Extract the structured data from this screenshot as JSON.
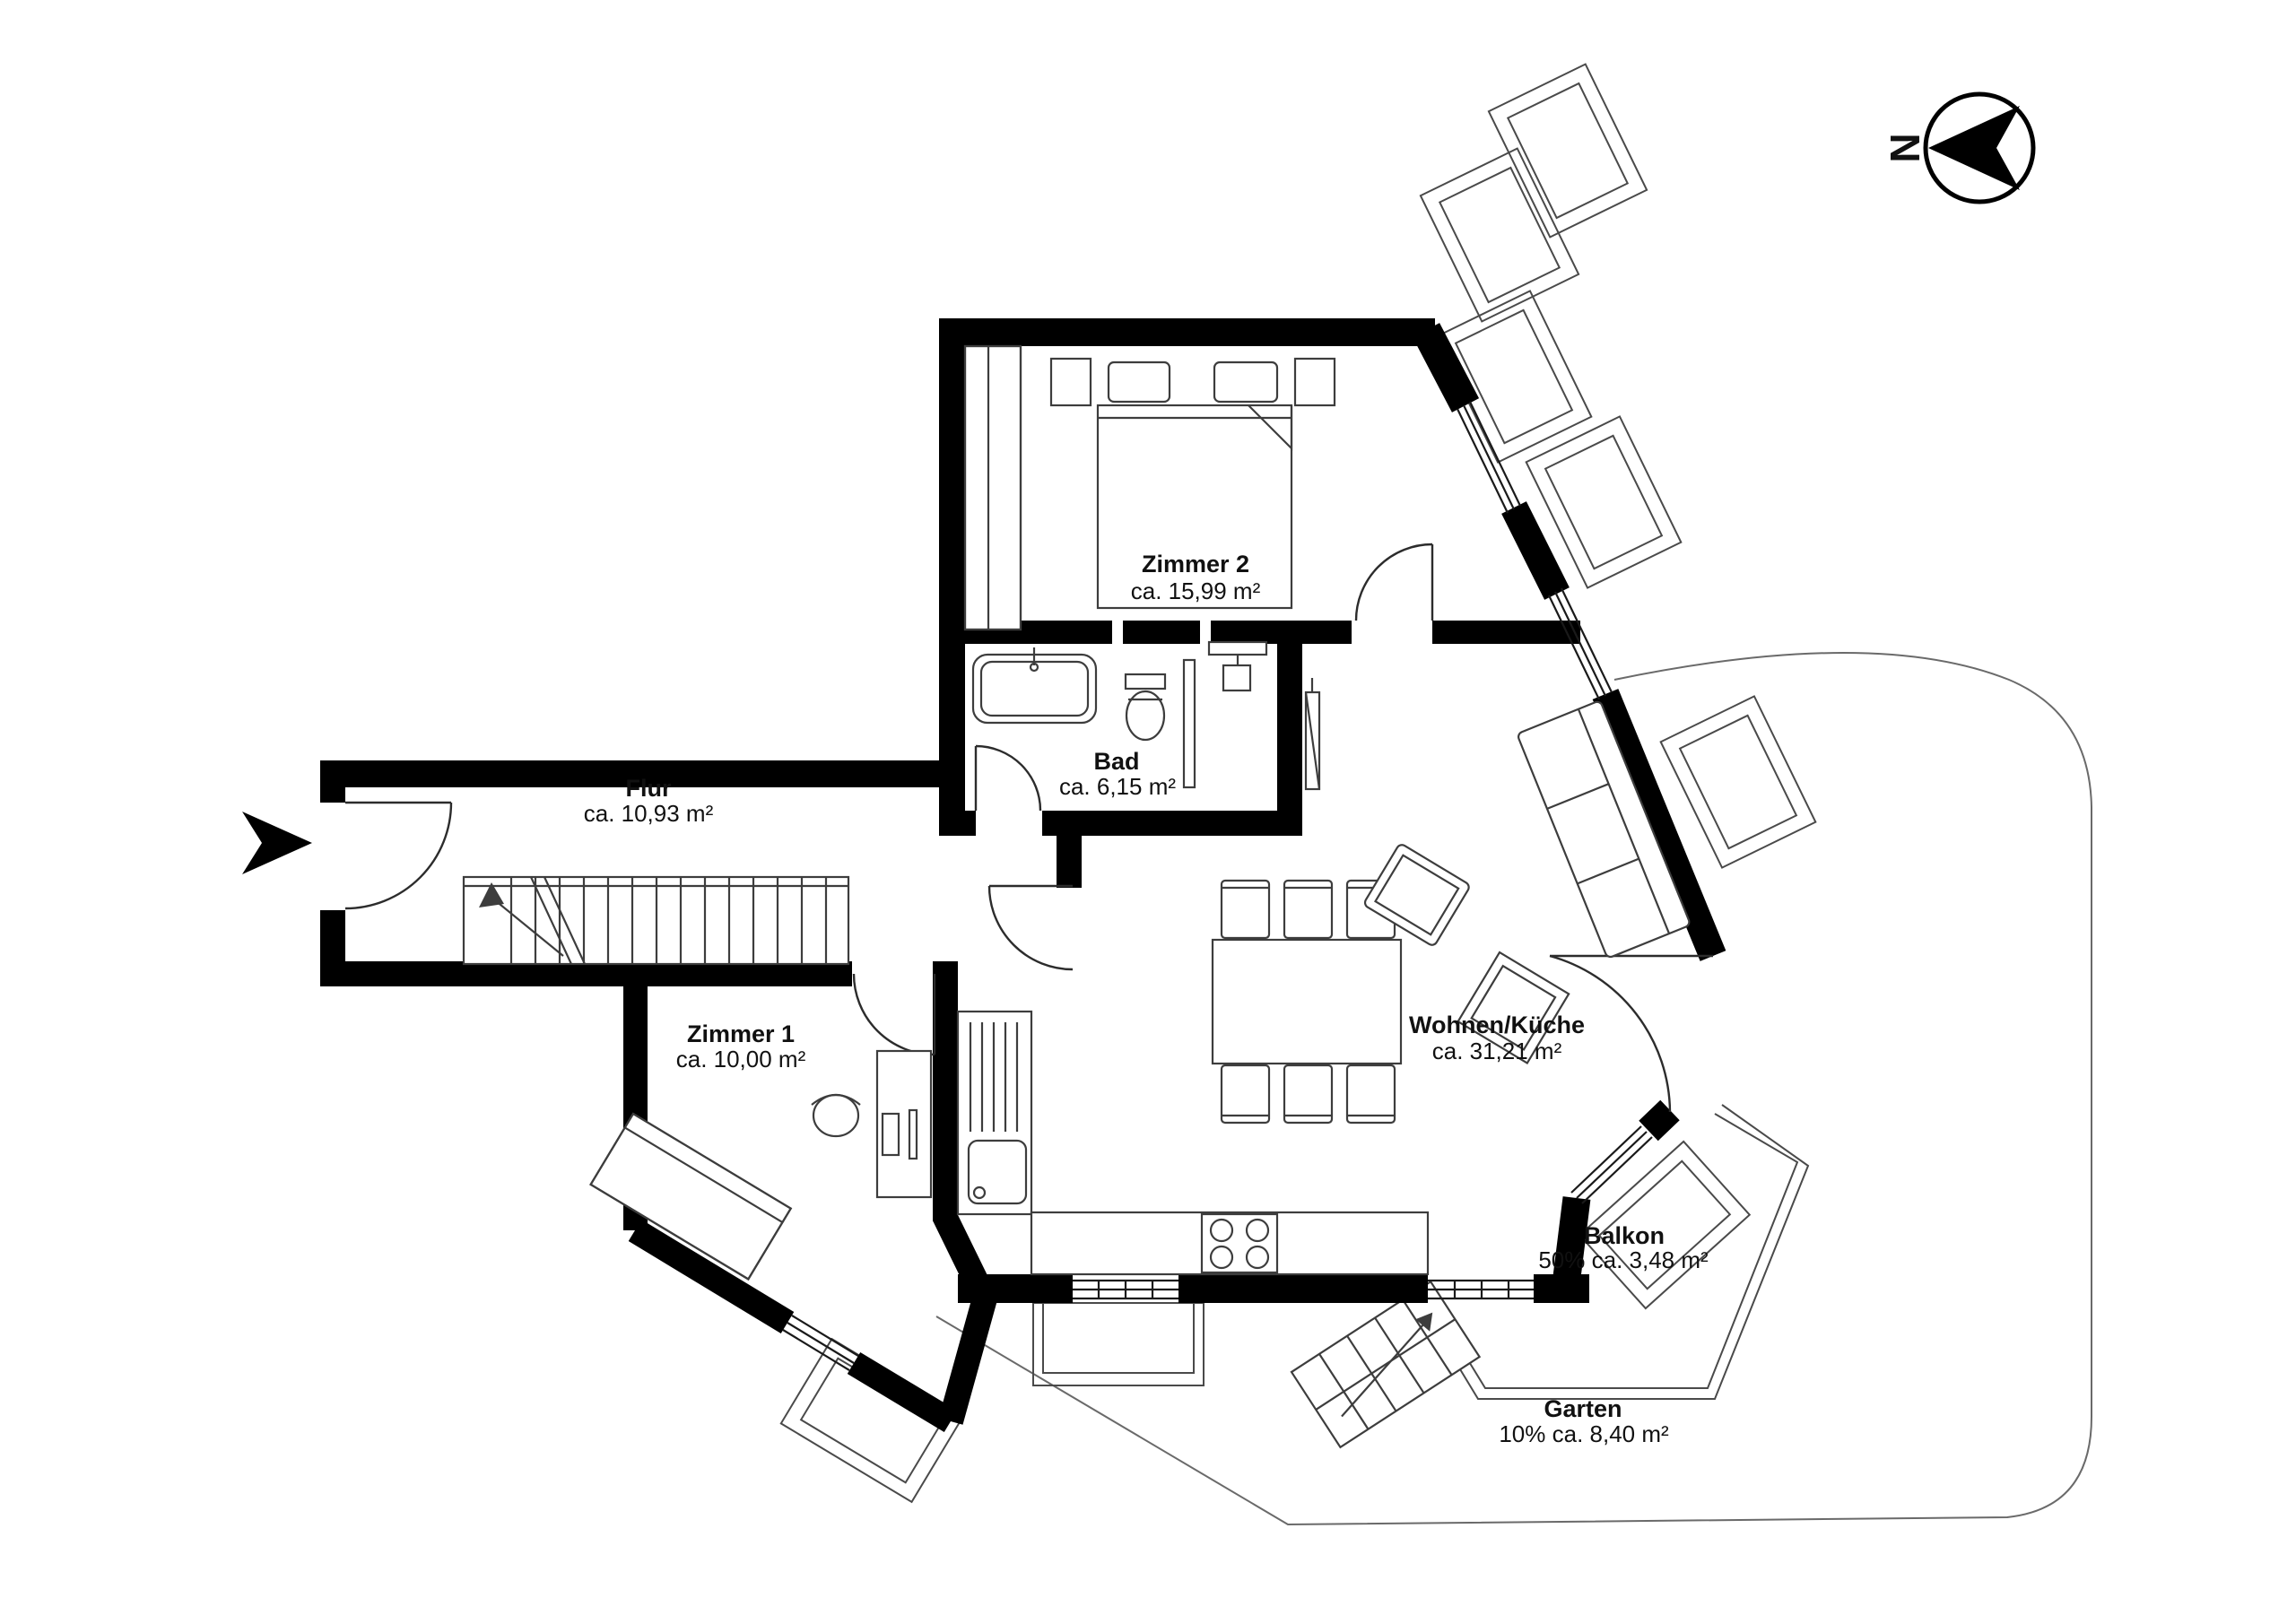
{
  "document": {
    "kind": "floor-plan"
  },
  "colors": {
    "wall": "#000000",
    "furniture_outline": "#3d3d3d",
    "thin_outline": "#4a4a4a",
    "background": "#ffffff"
  },
  "compass": {
    "direction_label": "N"
  },
  "rooms": [
    {
      "id": "zimmer-2",
      "name": "Zimmer 2",
      "area": "ca. 15,99 m²"
    },
    {
      "id": "bad",
      "name": "Bad",
      "area": "ca. 6,15 m²"
    },
    {
      "id": "flur",
      "name": "Flur",
      "area": "ca. 10,93 m²"
    },
    {
      "id": "zimmer-1",
      "name": "Zimmer 1",
      "area": "ca. 10,00 m²"
    },
    {
      "id": "wohnen-kueche",
      "name": "Wohnen/Küche",
      "area": "ca. 31,21 m²"
    },
    {
      "id": "balkon",
      "name": "Balkon",
      "area": "50% ca. 3,48 m²"
    },
    {
      "id": "garten",
      "name": "Garten",
      "area": "10% ca. 8,40 m²"
    }
  ]
}
